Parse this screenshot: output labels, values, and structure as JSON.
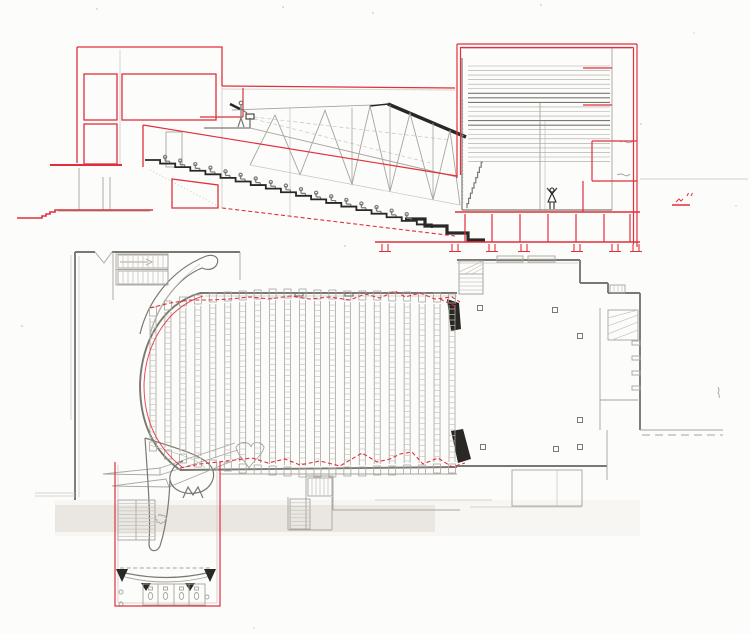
{
  "drawing": {
    "kind": "hand-drawn theater section and floor plan, pencil with red ink overlay",
    "visible_text": []
  },
  "colors": {
    "paper": "#fcfcfa",
    "red_ink": "#e12f3d",
    "pencil_faint": "#c8c5c0",
    "pencil_light": "#a7a49e",
    "pencil_mid": "#7b7872",
    "pencil_dark": "#2a2824",
    "smudge": "rgba(170,156,140,0.16)"
  },
  "gen": {
    "rake": {
      "x0": 145,
      "y0": 160,
      "steps": 19,
      "run": 15.1,
      "rise": 3.58
    },
    "section_seats": {
      "count": 17
    },
    "fly_lines": {
      "x1": 468,
      "x2": 610,
      "y0": 66,
      "count": 22,
      "dy": 4.55,
      "dark_idx": [
        6,
        7,
        8,
        12,
        13
      ]
    },
    "basement_cols": [
      465,
      492,
      520,
      548,
      576,
      604,
      630
    ],
    "pier_pairs": [
      385,
      455,
      492,
      524,
      577,
      615,
      636
    ],
    "plan_rows": {
      "first_x": 153,
      "spacing": 14.95,
      "count": 21,
      "rung_pitch": 5.5,
      "tops": [
        318,
        312,
        308,
        306,
        304,
        303,
        302,
        301,
        300,
        300,
        300,
        301,
        301,
        302,
        302,
        302,
        303,
        303,
        304,
        304,
        305
      ],
      "bottoms": [
        440,
        448,
        452,
        456,
        458,
        460,
        462,
        463,
        464,
        465,
        466,
        466,
        466,
        465,
        465,
        464,
        464,
        463,
        463,
        462,
        462
      ]
    },
    "stage_columns": [
      [
        480,
        308
      ],
      [
        555,
        310
      ],
      [
        580,
        336
      ],
      [
        580,
        420
      ],
      [
        580,
        447
      ],
      [
        556,
        449
      ],
      [
        483,
        447
      ]
    ],
    "zigzag_top": [
      [
        150,
        308
      ],
      [
        170,
        303
      ],
      [
        190,
        300
      ],
      [
        210,
        300
      ],
      [
        230,
        299
      ],
      [
        250,
        297
      ],
      [
        270,
        299
      ],
      [
        290,
        296
      ],
      [
        310,
        299
      ],
      [
        330,
        297
      ],
      [
        350,
        300
      ],
      [
        365,
        294
      ],
      [
        380,
        298
      ],
      [
        395,
        291
      ],
      [
        405,
        297
      ],
      [
        420,
        293
      ],
      [
        435,
        299
      ],
      [
        452,
        297
      ],
      [
        460,
        302
      ]
    ],
    "zigzag_bottom": [
      [
        180,
        468
      ],
      [
        200,
        464
      ],
      [
        218,
        462
      ],
      [
        235,
        460
      ],
      [
        252,
        458
      ],
      [
        268,
        463
      ],
      [
        285,
        459
      ],
      [
        300,
        465
      ],
      [
        320,
        461
      ],
      [
        340,
        466
      ],
      [
        362,
        453
      ],
      [
        377,
        462
      ],
      [
        390,
        459
      ],
      [
        400,
        454
      ],
      [
        412,
        452
      ],
      [
        423,
        464
      ],
      [
        438,
        458
      ],
      [
        452,
        467
      ],
      [
        465,
        463
      ]
    ],
    "truss": {
      "bottom_x": [
        250,
        300,
        352,
        390,
        433,
        460
      ],
      "top_x": [
        275,
        325,
        370,
        410,
        450
      ],
      "verticals": [
        352,
        390,
        433
      ]
    },
    "stair_blocks": [
      {
        "x": 118,
        "y": 255,
        "w": 50,
        "h": 13,
        "treads": 10,
        "dir": "v"
      },
      {
        "x": 118,
        "y": 271,
        "w": 50,
        "h": 13,
        "treads": 10,
        "dir": "v"
      },
      {
        "x": 459,
        "y": 274,
        "w": 24,
        "h": 20,
        "treads": 5,
        "dir": "h"
      },
      {
        "x": 308,
        "y": 478,
        "w": 24,
        "h": 18,
        "treads": 6,
        "dir": "v"
      },
      {
        "x": 290,
        "y": 499,
        "w": 20,
        "h": 30,
        "treads": 8,
        "dir": "h"
      },
      {
        "x": 118,
        "y": 500,
        "w": 37,
        "h": 40,
        "treads": 11,
        "dir": "h"
      }
    ]
  }
}
